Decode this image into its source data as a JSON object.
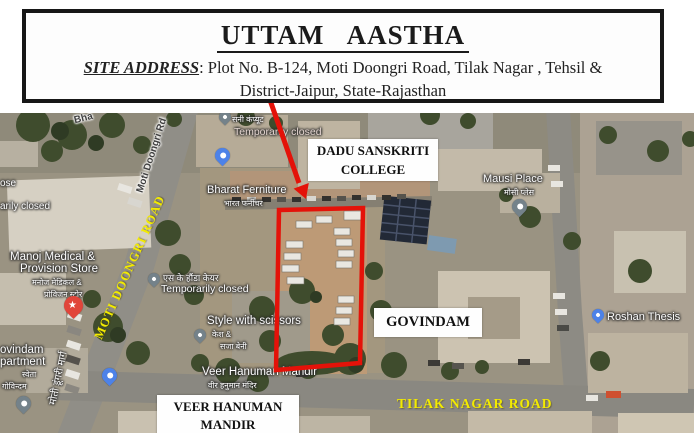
{
  "header": {
    "title": "UTTAM AASTHA",
    "address_label": "SITE ADDRESS",
    "address_line1": ": Plot No. B-124, Moti Doongri Road, Tilak Nagar , Tehsil &",
    "address_line2": "District-Jaipur, State-Rajasthan"
  },
  "overlays": {
    "dadu_line1": "DADU SANSKRITI",
    "dadu_line2": "COLLEGE",
    "govindam": "GOVINDAM",
    "mandir_line1": "VEER HANUMAN",
    "mandir_line2": "MANDIR",
    "moti_road": "MOTI DOONGRI ROAD",
    "tilak_road": "TILAK NAGAR ROAD",
    "accent_red": "#e41209",
    "accent_yellow": "#f3eb00"
  },
  "map_labels": {
    "top_fragment": "Bha",
    "moti_doongri_rd": "Moti Doongri Rd",
    "sunny_computer_hi": "सनी कंप्यूट",
    "temporarily_closed_top": "Temporarily closed",
    "bharat_furniture": "Bharat Ferniture",
    "bharat_furniture_hi": "भारत फर्नीचर",
    "mausi_place": "Mausi Place",
    "mausi_place_hi": "मौसी प्लेस",
    "fragment_ose": "ose",
    "fragment_arily_closed": "arily closed",
    "manoj_line1": "Manoj Medical &",
    "manoj_line2": "Provision Store",
    "manoj_hi1": "मनोज मेडिकल &",
    "manoj_hi2": "प्रोविजन स्टोर",
    "sk_honda_hi": "एस के हौंडा केयर",
    "temporarily_closed_mid": "Temporarily closed",
    "style_scissors": "Style with scissors",
    "style_hi1": "केश &",
    "style_hi2": "सजा बेनी",
    "govindam_apt_line1": "ovindam",
    "govindam_apt_line2": "partment",
    "govindam_apt_hi1": "स्वेता",
    "govindam_apt_hi2": "गोविन्दम",
    "moti_marg_hi": "मोती डूंगरी मार्ग",
    "veer_hanuman": "Veer Hanuman Mandir",
    "veer_hanuman_hi": "वीर हनुमान मंदिर",
    "roshan_thesis": "Roshan Thesis"
  },
  "icons": {
    "star": "★",
    "college": "◆"
  }
}
